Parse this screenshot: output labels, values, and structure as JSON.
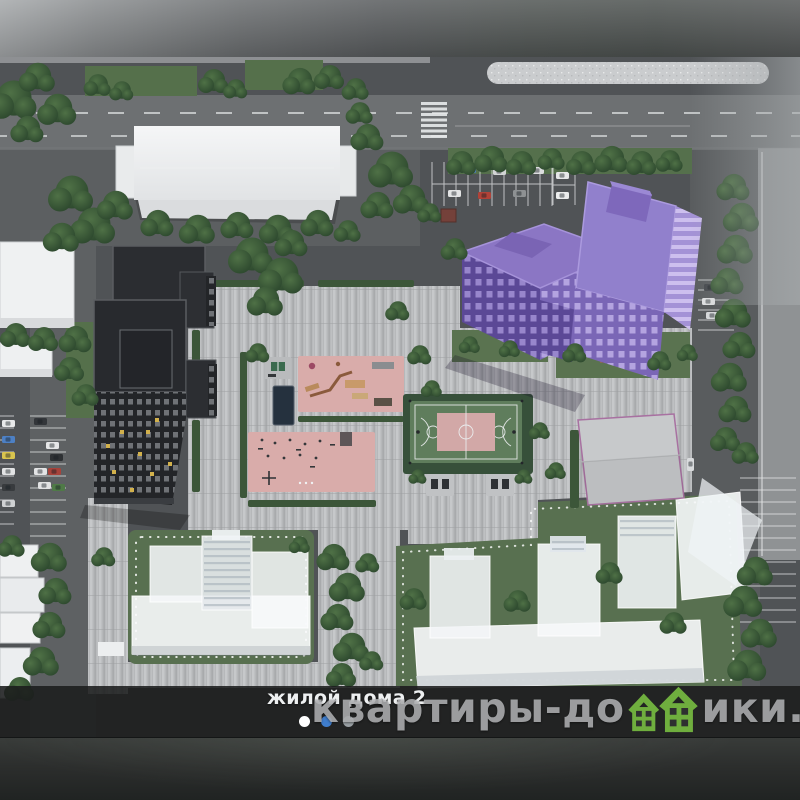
{
  "carousel": {
    "caption": "жилой дома 2",
    "dots": [
      {
        "state": "viewed",
        "color": "#ffffff"
      },
      {
        "state": "active",
        "color": "#3f7dcc"
      },
      {
        "state": "default",
        "color": "#9aa0a4"
      }
    ]
  },
  "watermark": {
    "prefix": "квартиры-до",
    "suffix": "ики.рф",
    "icon": "green-houses-icon",
    "icon_color": "#6fae3e",
    "text_color": "#b9bbbd"
  },
  "scene": {
    "type": "aerial-3d-masterplan-render",
    "highlighted_building": "purple-residential-tower",
    "elements": [
      "purple-residential-tower",
      "dark-residential-tower",
      "white-industrial-building",
      "planned-ghost-buildings",
      "gray-roof-building",
      "basketball-court",
      "playground",
      "fitness-area",
      "parking-lots",
      "roads",
      "trees",
      "paved-plaza"
    ],
    "palette": {
      "highlight_purple": "#8b76c4",
      "dark_building": "#26282b",
      "pavement": "#b7b9bb",
      "asphalt": "#54575a",
      "grass": "#587050",
      "court_green": "#5f7d5c",
      "area_pink": "#d9acaa"
    }
  }
}
